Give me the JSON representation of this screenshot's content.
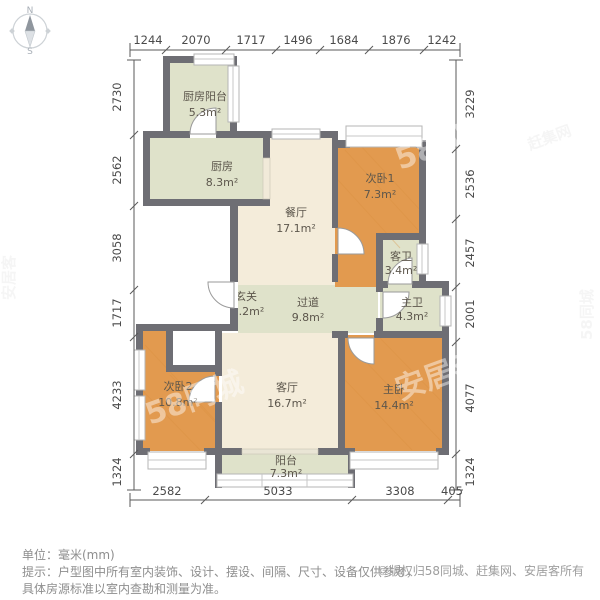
{
  "compass": {
    "north": "N",
    "south": "S"
  },
  "rooms": {
    "kitchen_balcony": {
      "name": "厨房阳台",
      "area": "5.3m²"
    },
    "kitchen": {
      "name": "厨房",
      "area": "8.3m²"
    },
    "dining": {
      "name": "餐厅",
      "area": "17.1m²"
    },
    "bedroom1": {
      "name": "次卧1",
      "area": "7.3m²"
    },
    "guest_bath": {
      "name": "客卫",
      "area": "3.4m²"
    },
    "hallway": {
      "name": "过道",
      "area": "9.8m²"
    },
    "master_bath": {
      "name": "主卫",
      "area": "4.3m²"
    },
    "entry": {
      "name": "玄关",
      "area": "2.2m²"
    },
    "bedroom2": {
      "name": "次卧2",
      "area": "10.8m²"
    },
    "living": {
      "name": "客厅",
      "area": "16.7m²"
    },
    "master_bedroom": {
      "name": "主卧",
      "area": "14.4m²"
    },
    "balcony": {
      "name": "阳台",
      "area": "7.3m²"
    }
  },
  "dimensions": {
    "top": [
      "1244",
      "2070",
      "1717",
      "1496",
      "1684",
      "1876",
      "1242"
    ],
    "left": [
      "2730",
      "2562",
      "3058",
      "1717",
      "4233",
      "1324"
    ],
    "right": [
      "3229",
      "2536",
      "2457",
      "2001",
      "4077",
      "1324"
    ],
    "bottom": [
      "2582",
      "5033",
      "3308",
      "405"
    ]
  },
  "notes": {
    "unit": "单位：毫米(mm)",
    "tip_line1": "提示：户型图中所有室内装饰、设计、摆设、间隔、尺寸、设备仅供参考，",
    "tip_line2": "具体房源标准以室内查勘和测量为准。",
    "copyright": "©版权归58同城、赶集网、安居客所有"
  },
  "watermarks": {
    "inner": [
      "58同城",
      "58同城",
      "安居客"
    ],
    "edge": [
      "安居客",
      "58同城",
      "赶集网"
    ]
  },
  "colors": {
    "wall": "#6e6e74",
    "floor_cream": "#f4ecda",
    "floor_sage": "#dfe2ca",
    "floor_wood": "#e29a4f",
    "note_gray": "#8e8e8e"
  }
}
